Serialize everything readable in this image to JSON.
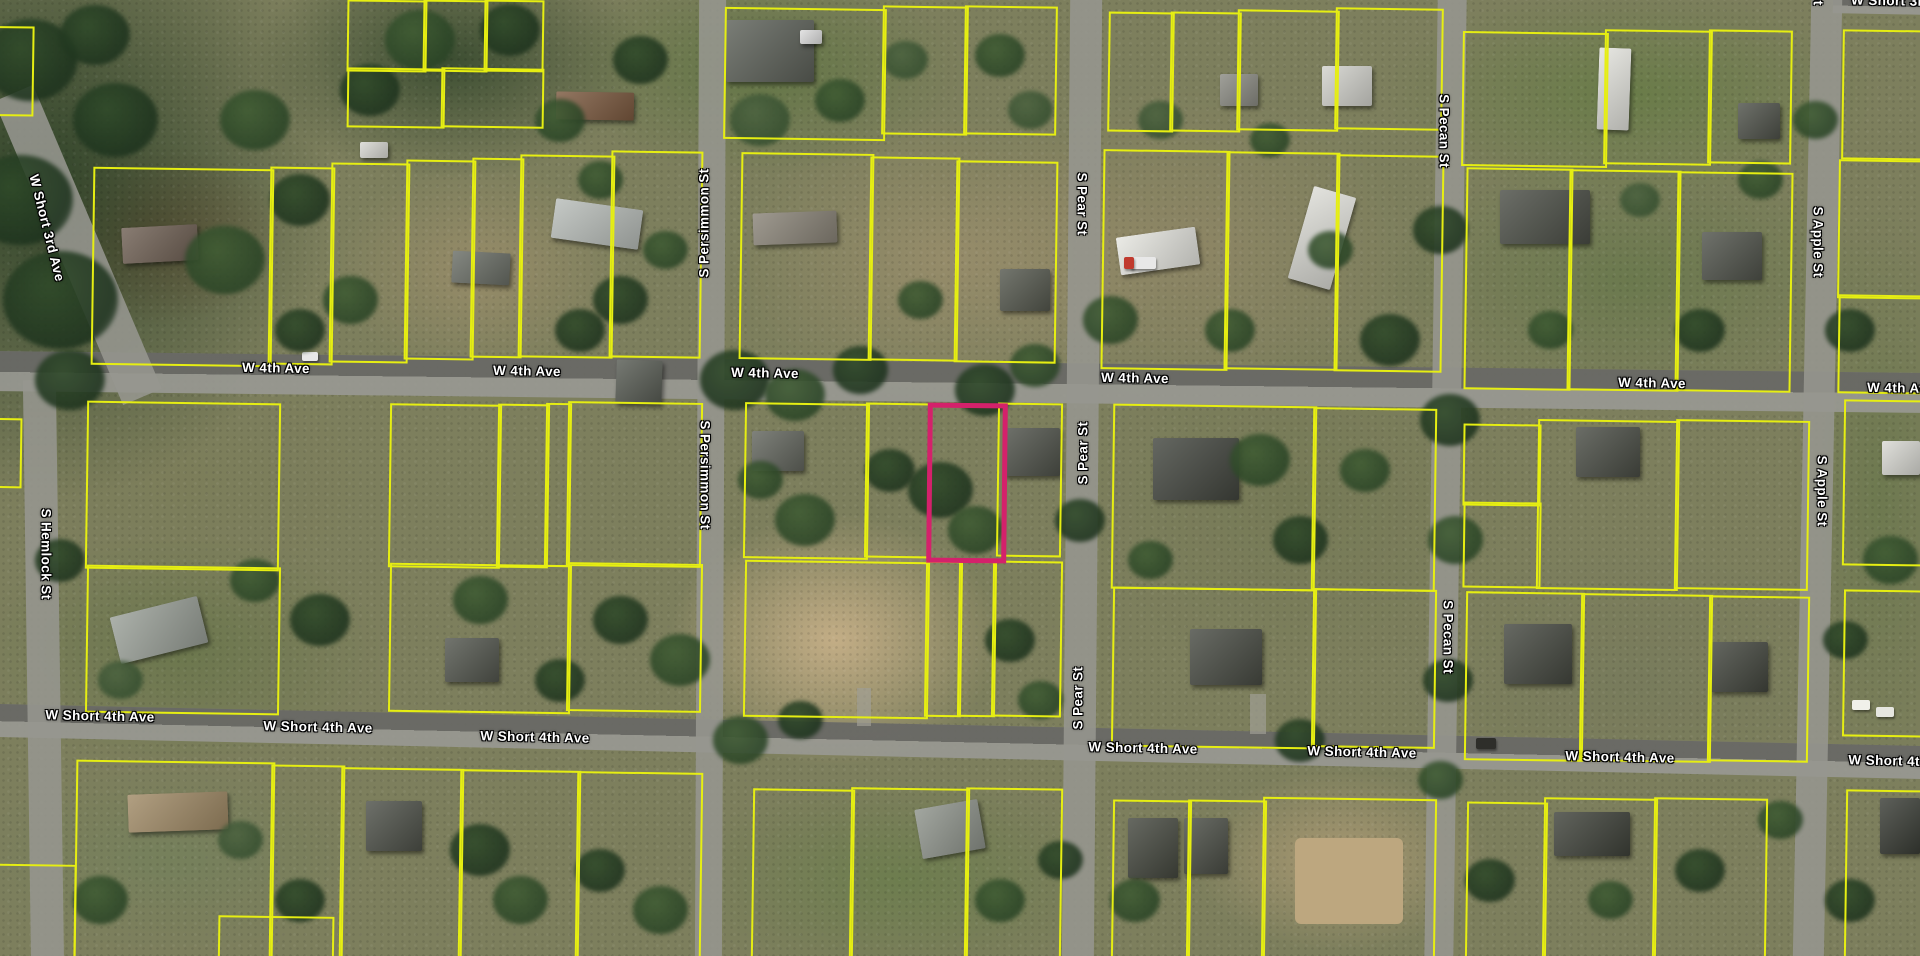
{
  "map": {
    "type": "satellite-parcel-view",
    "colors": {
      "parcel_line": "#e6ee12",
      "selected_parcel_line": "#d4216b",
      "road_fill": "#96968f",
      "street_label_text": "#ffffff"
    },
    "streets": {
      "avenues": [
        "W 4th Ave",
        "W Short 4th Ave",
        "W Short 3rd Ave"
      ],
      "streets": [
        "S Hemlock St",
        "S Persimmon St",
        "S Pear St",
        "S Pecan St",
        "S Apple St"
      ]
    },
    "roads": [
      {
        "name": "W 4th Ave",
        "x": -10,
        "y": 362,
        "w": 1940,
        "h": 40,
        "r": 0.65,
        "kind": "avenue"
      },
      {
        "name": "W Short 4th Ave",
        "x": -10,
        "y": 725,
        "w": 1940,
        "h": 33,
        "r": 1.25,
        "kind": "avenue"
      },
      {
        "name": "W Short 3rd Ave",
        "x": 57,
        "y": 80,
        "w": 42,
        "h": 330,
        "r": -23,
        "kind": "street"
      },
      {
        "name": "W Short 3rd Ave",
        "x": 1833,
        "y": -2,
        "w": 95,
        "h": 16,
        "r": 1,
        "kind": "avenue"
      },
      {
        "name": "S Hemlock St",
        "x": 27,
        "y": 380,
        "w": 33,
        "h": 590,
        "r": -0.8,
        "kind": "street"
      },
      {
        "name": "S Persimmon St",
        "x": 697,
        "y": -10,
        "w": 27,
        "h": 980,
        "r": 0.25,
        "kind": "street"
      },
      {
        "name": "S Pear St",
        "x": 1066,
        "y": -10,
        "w": 32,
        "h": 980,
        "r": 0.5,
        "kind": "street"
      },
      {
        "name": "S Pecan St",
        "x": 1431,
        "y": -10,
        "w": 29,
        "h": 980,
        "r": 0.8,
        "kind": "street"
      },
      {
        "name": "S Apple St",
        "x": 1802,
        "y": -10,
        "w": 31,
        "h": 980,
        "r": 1.1,
        "kind": "street"
      }
    ],
    "street_labels": [
      {
        "text": "W 4th Ave",
        "x": 276,
        "y": 368,
        "r": 1
      },
      {
        "text": "W 4th Ave",
        "x": 527,
        "y": 371,
        "r": 1
      },
      {
        "text": "W 4th Ave",
        "x": 765,
        "y": 373,
        "r": 1
      },
      {
        "text": "W 4th Ave",
        "x": 1135,
        "y": 378,
        "r": 1
      },
      {
        "text": "W 4th Ave",
        "x": 1652,
        "y": 383,
        "r": 1
      },
      {
        "text": "W 4th Ave",
        "x": 1901,
        "y": 388,
        "r": 1
      },
      {
        "text": "W Short 4th Ave",
        "x": 100,
        "y": 716,
        "r": 1.3
      },
      {
        "text": "W Short 4th Ave",
        "x": 318,
        "y": 727,
        "r": 1.3
      },
      {
        "text": "W Short 4th Ave",
        "x": 535,
        "y": 737,
        "r": 1.3
      },
      {
        "text": "W Short 4th Ave",
        "x": 1143,
        "y": 748,
        "r": 1.3
      },
      {
        "text": "W Short 4th Ave",
        "x": 1362,
        "y": 752,
        "r": 1.3
      },
      {
        "text": "W Short 4th Ave",
        "x": 1620,
        "y": 757,
        "r": 1.3
      },
      {
        "text": "W Short 4th Ave",
        "x": 1903,
        "y": 761,
        "r": 1.3
      },
      {
        "text": "W Short 3rd Ave",
        "x": 47,
        "y": 228,
        "r": 76
      },
      {
        "text": "W Short 3rd Ave",
        "x": 1906,
        "y": 1,
        "r": 1
      },
      {
        "text": "S Persimmon St",
        "x": 704,
        "y": 223,
        "r": -90
      },
      {
        "text": "S Persimmon St",
        "x": 705,
        "y": 475,
        "r": 90
      },
      {
        "text": "S Pear St",
        "x": 1082,
        "y": 204,
        "r": 90
      },
      {
        "text": "S Pear St",
        "x": 1083,
        "y": 453,
        "r": -90
      },
      {
        "text": "S Pear St",
        "x": 1078,
        "y": 698,
        "r": -90
      },
      {
        "text": "S Pecan St",
        "x": 1444,
        "y": 131,
        "r": 90
      },
      {
        "text": "S Pecan St",
        "x": 1448,
        "y": 637,
        "r": 90
      },
      {
        "text": "S Apple St",
        "x": 1818,
        "y": 242,
        "r": 90
      },
      {
        "text": "S Apple St",
        "x": 1822,
        "y": 491,
        "r": 90
      },
      {
        "text": "S Apple St",
        "x": 1818,
        "y": -30,
        "r": 90
      },
      {
        "text": "S Hemlock St",
        "x": 46,
        "y": 554,
        "r": 90
      }
    ],
    "selected_parcel": {
      "x": 927,
      "y": 403,
      "w": 70,
      "h": 150,
      "r": 0.6,
      "stroke": "#d4216b",
      "stroke_width": 5
    },
    "parcel_default_rotation": 0.8,
    "parcels": [
      [
        -45,
        26,
        75,
        86
      ],
      [
        347,
        0,
        76,
        68
      ],
      [
        423,
        0,
        61,
        68
      ],
      [
        484,
        0,
        56,
        68
      ],
      [
        347,
        68,
        94,
        56
      ],
      [
        441,
        68,
        99,
        56
      ],
      [
        92,
        168,
        177,
        194
      ],
      [
        269,
        167,
        61,
        194
      ],
      [
        330,
        163,
        75,
        196
      ],
      [
        405,
        160,
        66,
        196
      ],
      [
        471,
        158,
        48,
        196
      ],
      [
        519,
        155,
        91,
        199
      ],
      [
        610,
        151,
        88,
        203
      ],
      [
        724,
        8,
        158,
        128
      ],
      [
        882,
        6,
        82,
        125
      ],
      [
        964,
        6,
        89,
        125
      ],
      [
        740,
        153,
        129,
        203
      ],
      [
        869,
        157,
        86,
        200
      ],
      [
        955,
        161,
        98,
        198
      ],
      [
        1108,
        12,
        62,
        116
      ],
      [
        1170,
        12,
        67,
        116
      ],
      [
        1237,
        10,
        98,
        117
      ],
      [
        1335,
        8,
        104,
        118
      ],
      [
        1102,
        150,
        123,
        216
      ],
      [
        1225,
        152,
        110,
        214
      ],
      [
        1335,
        155,
        104,
        213
      ],
      [
        1462,
        32,
        142,
        131
      ],
      [
        1604,
        30,
        104,
        131
      ],
      [
        1708,
        30,
        80,
        130
      ],
      [
        1465,
        168,
        103,
        218
      ],
      [
        1568,
        170,
        108,
        217
      ],
      [
        1676,
        172,
        112,
        216
      ],
      [
        1842,
        30,
        95,
        126
      ],
      [
        1838,
        160,
        100,
        135
      ],
      [
        1838,
        295,
        100,
        95
      ],
      [
        -30,
        418,
        48,
        66
      ],
      [
        86,
        402,
        190,
        164
      ],
      [
        389,
        404,
        108,
        160
      ],
      [
        497,
        404,
        48,
        160
      ],
      [
        545,
        403,
        22,
        160
      ],
      [
        567,
        402,
        131,
        161
      ],
      [
        86,
        566,
        190,
        144
      ],
      [
        389,
        564,
        178,
        145
      ],
      [
        567,
        563,
        131,
        145
      ],
      [
        744,
        403,
        121,
        152
      ],
      [
        865,
        403,
        62,
        151
      ],
      [
        997,
        403,
        61,
        150
      ],
      [
        744,
        561,
        181,
        153
      ],
      [
        925,
        561,
        33,
        152
      ],
      [
        958,
        561,
        34,
        152
      ],
      [
        992,
        561,
        66,
        152
      ],
      [
        1112,
        405,
        200,
        181
      ],
      [
        1312,
        408,
        120,
        179
      ],
      [
        1112,
        588,
        200,
        156
      ],
      [
        1312,
        589,
        120,
        155
      ],
      [
        1463,
        424,
        74,
        78
      ],
      [
        1463,
        502,
        74,
        82
      ],
      [
        1537,
        420,
        138,
        166
      ],
      [
        1675,
        420,
        130,
        166
      ],
      [
        1465,
        592,
        115,
        165
      ],
      [
        1580,
        594,
        128,
        164
      ],
      [
        1708,
        596,
        97,
        162
      ],
      [
        1843,
        400,
        90,
        162
      ],
      [
        1843,
        590,
        80,
        143
      ],
      [
        75,
        761,
        195,
        195
      ],
      [
        270,
        765,
        70,
        191
      ],
      [
        340,
        768,
        119,
        188
      ],
      [
        459,
        770,
        117,
        186
      ],
      [
        576,
        772,
        122,
        184
      ],
      [
        218,
        916,
        112,
        60
      ],
      [
        752,
        789,
        98,
        167
      ],
      [
        850,
        788,
        115,
        168
      ],
      [
        965,
        788,
        93,
        168
      ],
      [
        1112,
        800,
        75,
        156
      ],
      [
        1187,
        800,
        75,
        156
      ],
      [
        1262,
        798,
        170,
        158
      ],
      [
        1466,
        802,
        77,
        154
      ],
      [
        1543,
        798,
        110,
        158
      ],
      [
        1653,
        798,
        110,
        158
      ],
      [
        1845,
        790,
        85,
        166
      ],
      [
        -40,
        864,
        112,
        92
      ]
    ],
    "buildings": [
      [
        122,
        226,
        76,
        36,
        "#6f6054",
        -3
      ],
      [
        360,
        142,
        28,
        16,
        "#d8d8d2",
        0
      ],
      [
        553,
        204,
        88,
        40,
        "#b8bdb9",
        8
      ],
      [
        452,
        252,
        58,
        32,
        "#6a6e66",
        3
      ],
      [
        556,
        92,
        78,
        28,
        "#7c5a40",
        1
      ],
      [
        726,
        20,
        88,
        62,
        "#5d6159",
        0
      ],
      [
        800,
        30,
        22,
        14,
        "#dedede",
        0
      ],
      [
        753,
        212,
        84,
        32,
        "#8a8478",
        -2
      ],
      [
        1000,
        269,
        50,
        42,
        "#55584e",
        0
      ],
      [
        1118,
        232,
        80,
        38,
        "#e6e6e0",
        -8
      ],
      [
        1300,
        190,
        44,
        96,
        "#dcdcd6",
        16
      ],
      [
        1322,
        66,
        50,
        40,
        "#d2d2cc",
        0
      ],
      [
        1220,
        74,
        38,
        32,
        "#8b8b83",
        0
      ],
      [
        1598,
        48,
        32,
        82,
        "#e2e2dc",
        2
      ],
      [
        1738,
        103,
        42,
        36,
        "#4f524a",
        0
      ],
      [
        1500,
        190,
        90,
        54,
        "#4b4e46",
        0
      ],
      [
        1702,
        232,
        60,
        48,
        "#50534b",
        0
      ],
      [
        616,
        360,
        46,
        44,
        "#585c54",
        2
      ],
      [
        752,
        431,
        52,
        40,
        "#63665e",
        0
      ],
      [
        1004,
        428,
        56,
        48,
        "#4f524a",
        0
      ],
      [
        1153,
        438,
        86,
        62,
        "#43463f",
        0
      ],
      [
        1190,
        629,
        72,
        56,
        "#484b43",
        0
      ],
      [
        1576,
        427,
        64,
        50,
        "#4a4d45",
        0
      ],
      [
        1504,
        624,
        68,
        60,
        "#454840",
        0
      ],
      [
        1710,
        642,
        58,
        50,
        "#43463e",
        0
      ],
      [
        1882,
        441,
        38,
        34,
        "#d9d9d3",
        0
      ],
      [
        114,
        606,
        90,
        48,
        "#9aa098",
        -14
      ],
      [
        445,
        638,
        54,
        44,
        "#53564e",
        0
      ],
      [
        128,
        793,
        100,
        38,
        "#a08a66",
        -2
      ],
      [
        366,
        801,
        56,
        50,
        "#4e5149",
        0
      ],
      [
        918,
        804,
        64,
        50,
        "#8e938b",
        -10
      ],
      [
        1128,
        818,
        50,
        60,
        "#45483f",
        0
      ],
      [
        1184,
        818,
        44,
        56,
        "#4a4d45",
        0
      ],
      [
        1554,
        812,
        76,
        44,
        "#3f423a",
        0
      ],
      [
        1880,
        798,
        40,
        56,
        "#3a3d36",
        0
      ]
    ],
    "ground_patches": [
      [
        1295,
        838,
        108,
        86,
        "#bda77f"
      ]
    ],
    "vehicles": [
      [
        302,
        352,
        16,
        9,
        "#e8e8e8"
      ],
      [
        1130,
        257,
        26,
        12,
        "#e8e8e8"
      ],
      [
        1124,
        257,
        10,
        12,
        "#c03a2e"
      ],
      [
        1852,
        700,
        18,
        10,
        "#f0f0ea"
      ],
      [
        1876,
        707,
        18,
        10,
        "#e6e6e0"
      ],
      [
        1476,
        738,
        20,
        11,
        "#2e2e2a"
      ]
    ]
  }
}
